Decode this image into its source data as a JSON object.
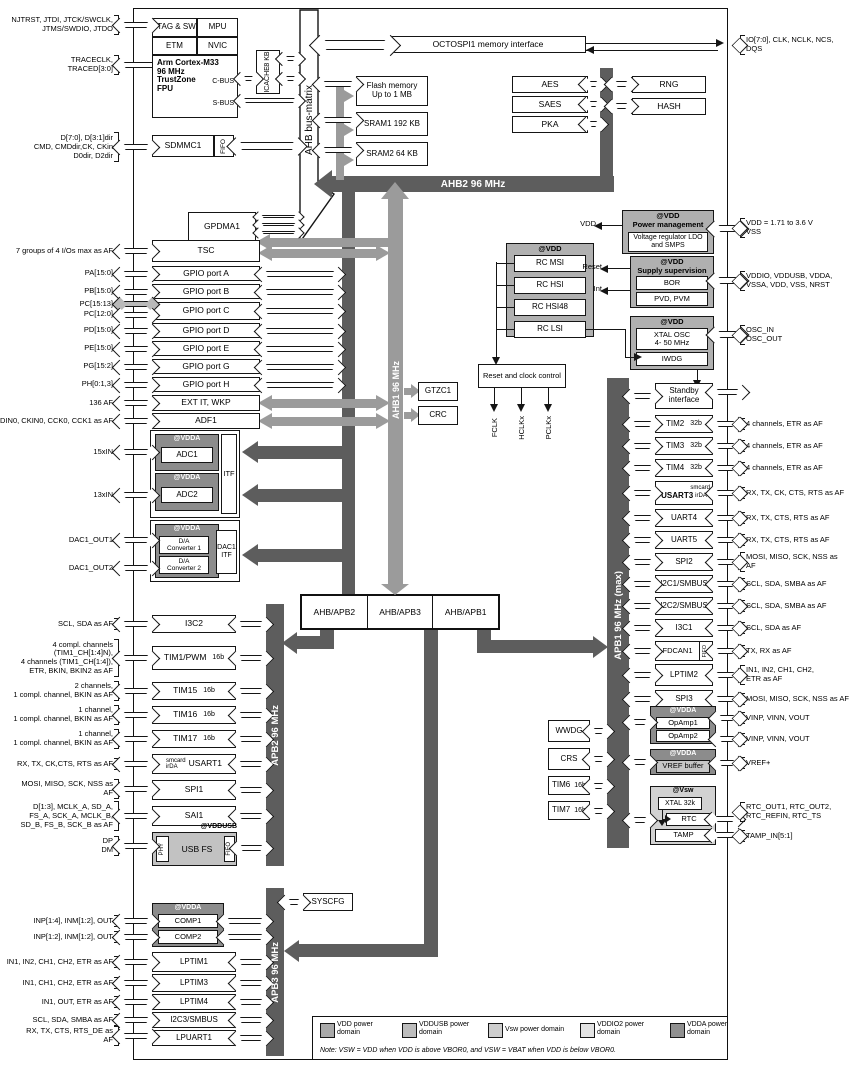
{
  "buses": {
    "ahb_matrix": "AHB bus-matrix",
    "ahb2": "AHB2 96 MHz",
    "ahb1": "AHB1 96 MHz",
    "apb2": "APB2 96 MHz",
    "apb1": "APB1 96 MHz (max)",
    "apb3": "APB3 96 MHz"
  },
  "debug": {
    "jtag": "JTAG & SW",
    "mpu": "MPU",
    "etm": "ETM",
    "nvic": "NVIC",
    "core": [
      "Arm Cortex-M33",
      "96 MHz",
      "TrustZone",
      "FPU"
    ],
    "cbus": "C-BUS",
    "sbus": "S-BUS",
    "icache": [
      "ICACHE",
      "8 KB"
    ]
  },
  "sdmmc": {
    "label": "SDMMC1",
    "fifo": "FIFO"
  },
  "pins_top_left": [
    [
      "NJTRST, JTDI, JTCK/SWCLK,",
      "JTMS/SWDIO, JTDO"
    ],
    [
      "TRACECLK,",
      "TRACED[3:0]"
    ],
    [
      "D[7:0], D[3:1]dir",
      "CMD, CMDdir,CK, CKin",
      "D0dir, D2dir"
    ]
  ],
  "octospi": {
    "label": "OCTOSPI1 memory interface",
    "pin": [
      "IO[7:0], CLK, NCLK, NCS,",
      "DQS"
    ]
  },
  "memories": [
    [
      "Flash memory",
      "Up to 1 MB"
    ],
    [
      "SRAM1 192 KB"
    ],
    [
      "SRAM2 64 KB"
    ]
  ],
  "crypto": {
    "left": [
      "AES",
      "SAES",
      "PKA"
    ],
    "right": [
      "RNG",
      "HASH"
    ]
  },
  "gpdma": "GPDMA1",
  "gpio": {
    "boxes": [
      "TSC",
      "GPIO port A",
      "GPIO port B",
      "GPIO port C",
      "GPIO port D",
      "GPIO port E",
      "GPIO port G",
      "GPIO port H",
      "EXT IT, WKP",
      "ADF1"
    ],
    "pins": [
      [
        "7 groups of 4 I/Os max as AF"
      ],
      [
        "PA[15:0]"
      ],
      [
        "PB[15:0]"
      ],
      [
        "PC[15:13]"
      ],
      [
        "PC[12:0]"
      ],
      [
        "PD[15:0]"
      ],
      [
        "PE[15:0]"
      ],
      [
        "PG[15:2]"
      ],
      [
        "PH[0:1,3]"
      ],
      [
        "136 AF"
      ],
      [
        "SDIN0, CKIN0, CCK0, CCK1 as AF"
      ]
    ]
  },
  "gtzc": "GTZC1",
  "crc": "CRC",
  "syscfg": "SYSCFG",
  "rcc": {
    "label": "Reset and clock control",
    "clocks": [
      "FCLK",
      "HCLKx",
      "PCLKx"
    ]
  },
  "osc": {
    "domain": "@VDD",
    "items": [
      "RC MSI",
      "RC HSI",
      "RC HSI48",
      "RC LSI"
    ]
  },
  "power": {
    "domain": "@VDD",
    "title": "Power management",
    "regulator": [
      "Voltage regulator LDO",
      "and SMPS"
    ],
    "vdd_out": "VDD",
    "pin": [
      "VDD = 1.71 to 3.6 V",
      "VSS"
    ]
  },
  "supervision": {
    "domain": "@VDD",
    "title": "Supply supervision",
    "items": [
      "BOR",
      "PVD, PVM"
    ],
    "reset_out": "Reset",
    "int_out": "Int",
    "pin": [
      "VDDIO, VDDUSB, VDDA,",
      "VSSA, VDD, VSS, NRST"
    ]
  },
  "xtal": {
    "domain": "@VDD",
    "osc": [
      "XTAL OSC",
      "4- 50 MHz"
    ],
    "iwdg": "IWDG",
    "pin": [
      "OSC_IN",
      "OSC_OUT"
    ]
  },
  "analog": {
    "domain": "@VDDA",
    "adc1": "ADC1",
    "adc2": "ADC2",
    "itf": "ITF",
    "dac": [
      "D/A",
      "Converter 1",
      "D/A",
      "Converter 2"
    ],
    "dac_itf": [
      "DAC1",
      "ITF"
    ],
    "pins": [
      [
        "15xIN"
      ],
      [
        "13xIN"
      ],
      [
        "DAC1_OUT1"
      ],
      [
        "DAC1_OUT2"
      ]
    ]
  },
  "bridges": [
    "AHB/APB2",
    "AHB/APB3",
    "AHB/APB1"
  ],
  "apb2_stack": [
    {
      "label": "I3C2",
      "pin": [
        "SCL, SDA as AF"
      ]
    },
    {
      "label": "TIM1/PWM",
      "tag": "16b",
      "pin": [
        "4 compl. channels",
        "(TIM1_CH[1:4]N),",
        "4 channels (TIM1_CH[1:4]),",
        "ETR, BKIN, BKIN2 as AF"
      ]
    },
    {
      "label": "TIM15",
      "tag": "16b",
      "pin": [
        "2 channels,",
        "1 compl. channel, BKIN as AF"
      ]
    },
    {
      "label": "TIM16",
      "tag": "16b",
      "pin": [
        "1 channel,",
        "1 compl. channel, BKIN as AF"
      ]
    },
    {
      "label": "TIM17",
      "tag": "16b",
      "pin": [
        "1 channel,",
        "1 compl. channel, BKIN as AF"
      ]
    },
    {
      "label": "USART1",
      "tag2": [
        "smcard",
        "irDA"
      ],
      "pin": [
        "RX, TX, CK,CTS, RTS as AF"
      ]
    },
    {
      "label": "SPI1",
      "pin": [
        "MOSI, MISO, SCK, NSS as",
        "AF"
      ]
    },
    {
      "label": "SAI1",
      "pin": [
        "D[1:3], MCLK_A, SD_A,",
        "FS_A, SCK_A, MCLK_B,",
        "SD_B, FS_B, SCK_B as AF"
      ]
    },
    {
      "label": "USB FS",
      "domain": "@VDDUSB",
      "phy": "PHY",
      "fifo": "FIFO",
      "pin": [
        "DP",
        "DM"
      ]
    }
  ],
  "comp_domain": "@VDDA",
  "apb3_stack": [
    {
      "label": "COMP1",
      "pin": [
        "INP[1:4], INM[1:2], OUT"
      ]
    },
    {
      "label": "COMP2",
      "pin": [
        "INP[1:2], INM[1:2], OUT"
      ]
    },
    {
      "label": "LPTIM1",
      "pin": [
        "IN1, IN2, CH1, CH2, ETR as AF"
      ]
    },
    {
      "label": "LPTIM3",
      "pin": [
        "IN1, CH1, CH2, ETR as AF"
      ]
    },
    {
      "label": "LPTIM4",
      "pin": [
        "IN1, OUT, ETR as AF"
      ]
    },
    {
      "label": "I2C3/SMBUS",
      "pin": [
        "SCL, SDA, SMBA as AF"
      ]
    },
    {
      "label": "LPUART1",
      "pin": [
        "RX, TX, CTS, RTS_DE as",
        "AF"
      ]
    }
  ],
  "apb1_stack": [
    {
      "label": [
        "Standby",
        "interface"
      ]
    },
    {
      "label": "TIM2",
      "tag": "32b",
      "pin": [
        "4 channels, ETR as AF"
      ]
    },
    {
      "label": "TIM3",
      "tag": "32b",
      "pin": [
        "4 channels, ETR as AF"
      ]
    },
    {
      "label": "TIM4",
      "tag": "32b",
      "pin": [
        "4 channels, ETR as AF"
      ]
    },
    {
      "label": "USART3",
      "tag2": [
        "smcard",
        "irDA"
      ],
      "pin": [
        "RX, TX, CK, CTS, RTS as AF"
      ]
    },
    {
      "label": "UART4",
      "pin": [
        "RX, TX, CTS, RTS as AF"
      ]
    },
    {
      "label": "UART5",
      "pin": [
        "RX, TX, CTS, RTS as AF"
      ]
    },
    {
      "label": "SPI2",
      "pin": [
        "MOSI, MISO, SCK, NSS as",
        "AF"
      ]
    },
    {
      "label": "I2C1/SMBUS",
      "pin": [
        "SCL, SDA, SMBA as AF"
      ]
    },
    {
      "label": "I2C2/SMBUS",
      "pin": [
        "SCL, SDA, SMBA as AF"
      ]
    },
    {
      "label": "I3C1",
      "pin": [
        "SCL, SDA as AF"
      ]
    },
    {
      "label": "FDCAN1",
      "fifo": "FIFO",
      "pin": [
        "TX, RX as AF"
      ]
    },
    {
      "label": "LPTIM2",
      "pin": [
        "IN1, IN2, CH1, CH2,",
        "ETR as AF"
      ]
    },
    {
      "label": "SPI3",
      "pin": [
        "MOSI, MISO, SCK, NSS as AF"
      ]
    }
  ],
  "opamp": {
    "domain": "@VDDA",
    "items": [
      "OpAmp1",
      "OpAmp2"
    ],
    "pins": [
      [
        "VINP, VINN, VOUT"
      ],
      [
        "VINP, VINN, VOUT"
      ]
    ]
  },
  "vref": {
    "domain": "@VDDA",
    "label": "VREF buffer",
    "pin": [
      "VREF+"
    ]
  },
  "rtc": {
    "domain": "@Vsw",
    "xtal": "XTAL 32k",
    "rtc": "RTC",
    "tamp": "TAMP",
    "rtc_pin": [
      "RTC_OUT1, RTC_OUT2,",
      "RTC_REFIN, RTC_TS"
    ],
    "tamp_pin": [
      "TAMP_IN[5:1]"
    ]
  },
  "mid_stack": [
    {
      "label": "WWDG"
    },
    {
      "label": "CRS"
    },
    {
      "label": "TIM6",
      "tag": "16b"
    },
    {
      "label": "TIM7",
      "tag": "16b"
    }
  ],
  "legend": {
    "items": [
      {
        "label": [
          "VDD power",
          "domain"
        ],
        "color": "#a9a9a9"
      },
      {
        "label": [
          "VDDUSB power",
          "domain"
        ],
        "color": "#bdbdbd"
      },
      {
        "label": [
          "Vsw power domain"
        ],
        "color": "#cecece"
      },
      {
        "label": [
          "VDDIO2 power",
          "domain"
        ],
        "color": "#e3e3e3"
      },
      {
        "label": [
          "VDDA power",
          "domain"
        ],
        "color": "#909090"
      }
    ],
    "note": "Note:  VSW = VDD when VDD is above VBOR0, and VSW = VBAT when VDD is below VBOR0."
  },
  "colors": {
    "bus_dark": "#5d5d5d",
    "bus_mid": "#9b9b9b",
    "vdd_fill": "#b0b0b0",
    "vdda_fill": "#8c8c8c",
    "vddusb_fill": "#c2c2c2",
    "vsw_fill": "#d2d2d2",
    "gray_pin": "#b9b9b9"
  }
}
